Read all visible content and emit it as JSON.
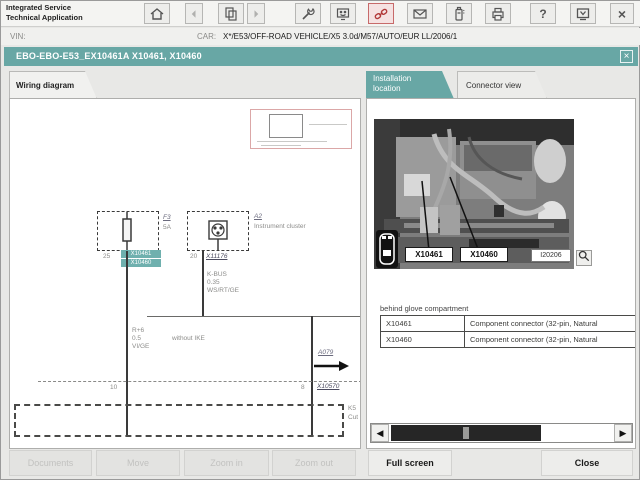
{
  "header": {
    "app_title_line1": "Integrated Service",
    "app_title_line2": "Technical Application",
    "vin_label": "VIN:",
    "vin_value": "",
    "car_label": "CAR:",
    "car_value": "X*/E53/OFF-ROAD VEHICLE/X5 3.0d/M57/AUTO/EUR LL/2006/1",
    "help_glyph": "?",
    "close_glyph": "×",
    "toolbar_icons": [
      "home-icon",
      "back-icon",
      "pages-icon",
      "forward-icon",
      "wrench-icon",
      "terminal-icon",
      "connection-icon",
      "mail-icon",
      "battery-icon",
      "printer-icon",
      "help-icon",
      "monitor-minimize-icon",
      "close-icon"
    ]
  },
  "document": {
    "title": "EBO-EBO-E53_EX10461A X10461, X10460",
    "close_glyph": "×"
  },
  "tabs": {
    "wiring_diagram": "Wiring diagram",
    "installation_location_line1": "Installation",
    "installation_location_line2": "location",
    "connector_view": "Connector view"
  },
  "diagram": {
    "fuse": {
      "ref": "F3",
      "rating": "5A",
      "pin": "25",
      "hit1": "X10461",
      "hit2": "X10460"
    },
    "cluster": {
      "ref": "A2",
      "name": "Instrument cluster",
      "pin": "20",
      "connector": "X11176"
    },
    "bus_wire": {
      "name": "K-BUS",
      "size": "0.35",
      "color": "WS/RT/GE"
    },
    "left_wire": {
      "circuit": "R+6",
      "size": "0.5",
      "color": "VI/GE"
    },
    "branch_note": "without IKE",
    "page_ref": "A079",
    "sep_pin_left": "10",
    "sep_pin_right": "8",
    "sep_connector": "X10570",
    "bottom_ref": "K5",
    "bottom_note": "Cut"
  },
  "installation": {
    "photo_label_1": "X10461",
    "photo_label_2": "X10460",
    "image_id": "I20206",
    "caption": "behind glove compartment",
    "table_rows": [
      {
        "name": "X10461",
        "desc": "Component connector (32-pin, Natural"
      },
      {
        "name": "X10460",
        "desc": "Component connector (32-pin, Natural"
      }
    ],
    "scroll_left_glyph": "◀",
    "scroll_right_glyph": "▶"
  },
  "footer": {
    "documents": "Documents",
    "move": "Move",
    "zoom_in": "Zoom in",
    "zoom_out": "Zoom out",
    "full_screen": "Full screen",
    "close": "Close"
  },
  "colors": {
    "teal": "#68a7a5",
    "highlight_teal": "#6fb0ae",
    "alert_red": "#b23a3a"
  }
}
